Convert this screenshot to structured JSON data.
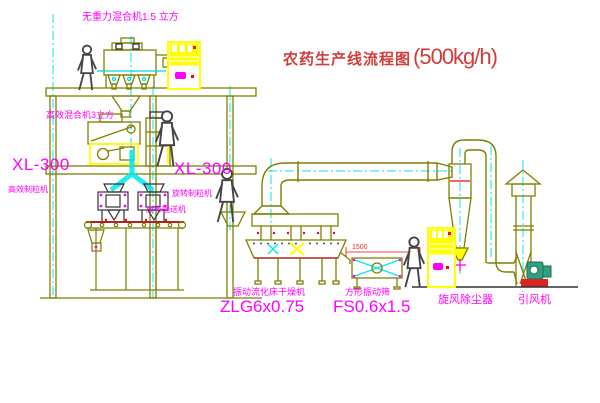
{
  "diagram": {
    "title": {
      "text": "农药生产线流程图",
      "capacity": "(500kg/h)"
    },
    "equipment_labels": {
      "top_mixer": "无重力混合机1.5 立方",
      "second_floor_mixer": "高效混合机3立方",
      "granulator_left": {
        "model": "XL-300",
        "name": "高效制粒机"
      },
      "granulator_mid": {
        "model": "XL-300",
        "name": "旋转制粒机"
      },
      "belt_conveyor": "皮带输送机",
      "dryer": {
        "name": "振动流化床干燥机",
        "model": "ZLG6x0.75"
      },
      "sieve": {
        "name": "方形振动筛",
        "model": "FS0.6x1.5"
      },
      "cyclone": "旋风除尘器",
      "fan": "引风机"
    },
    "dimensions": {
      "dryer_to_sieve": "1500"
    },
    "colors": {
      "line": "#7f7f00",
      "centerline": "#00e8e8",
      "label": "#ff00ff",
      "title": "#d43c3c",
      "highlight": "#ffff00",
      "alert": "#ff0000"
    }
  }
}
